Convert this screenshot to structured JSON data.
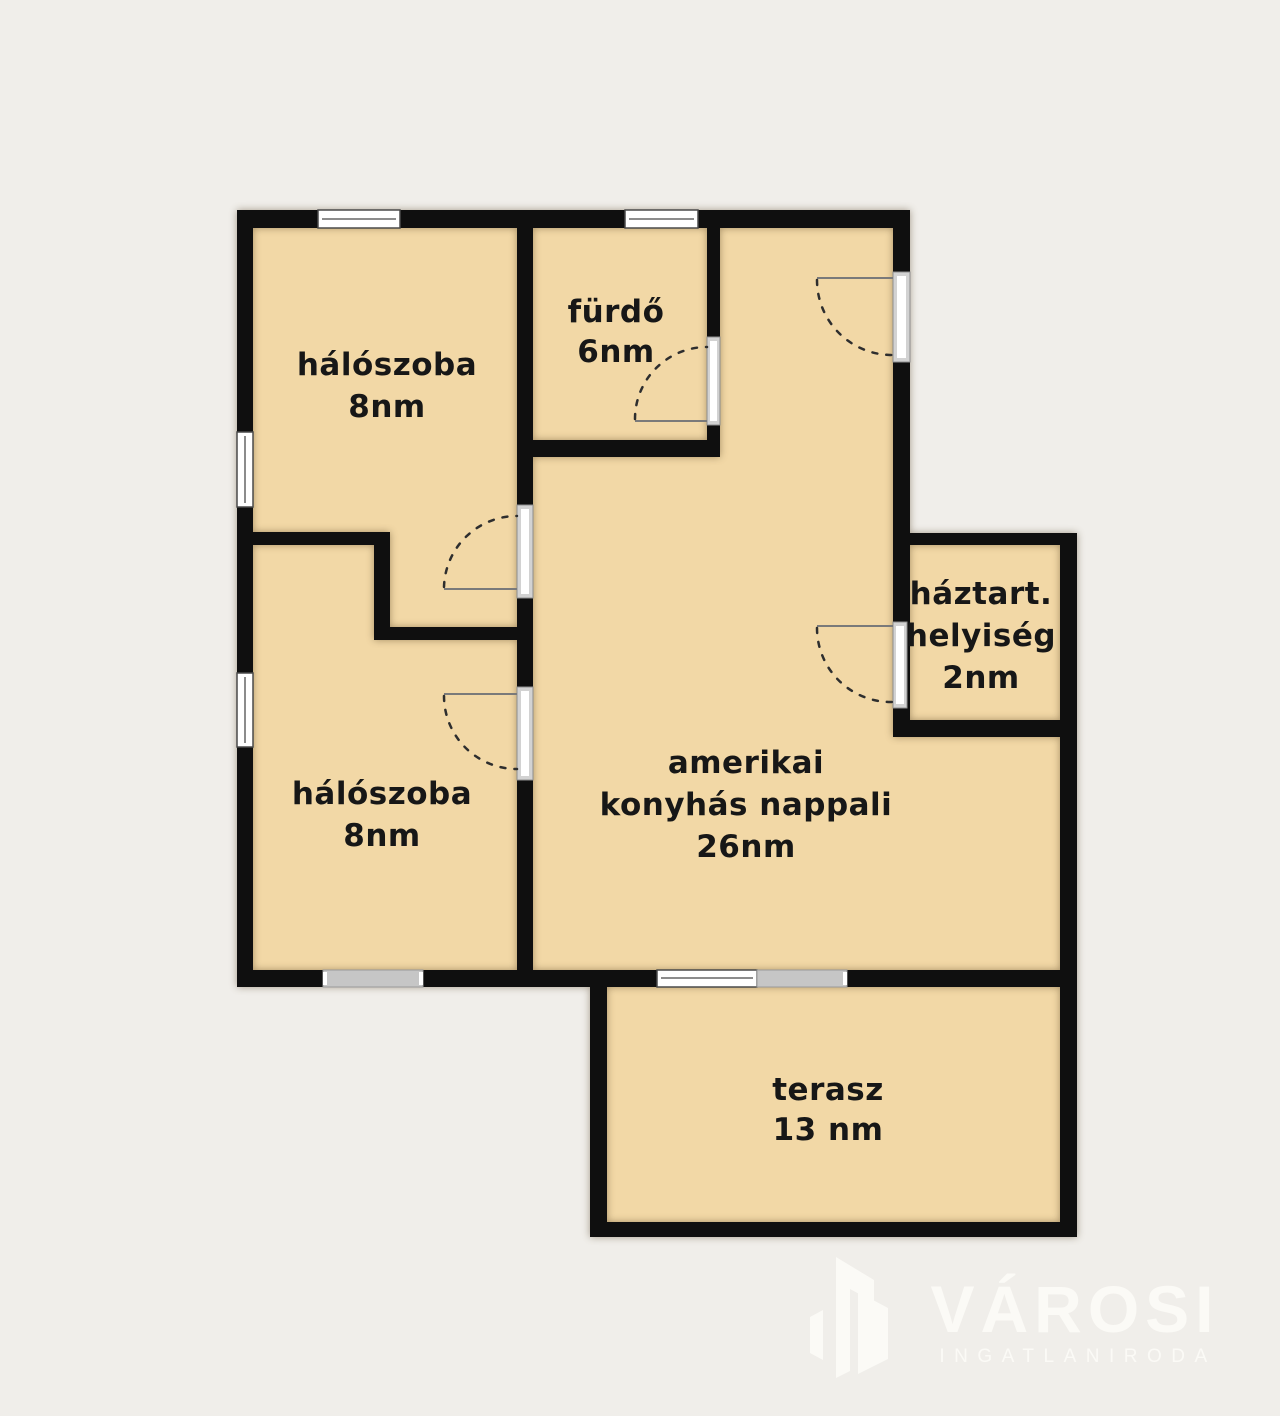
{
  "plan": {
    "rooms": [
      {
        "key": "bedroom_top",
        "lines": [
          "hálószoba"
        ],
        "area": "8nm"
      },
      {
        "key": "bathroom",
        "lines": [
          "fürdő"
        ],
        "area": "6nm"
      },
      {
        "key": "utility",
        "lines": [
          "háztart.",
          "helyiség"
        ],
        "area": "2nm"
      },
      {
        "key": "living",
        "lines": [
          "amerikai",
          "konyhás nappali"
        ],
        "area": "26nm"
      },
      {
        "key": "bedroom_bottom",
        "lines": [
          "hálószoba"
        ],
        "area": "8nm"
      },
      {
        "key": "terrace",
        "lines": [
          "terasz"
        ],
        "area": "13 nm"
      }
    ]
  },
  "logo": {
    "name": "VÁROSI",
    "tagline": "INGATLANIRODA"
  },
  "colors": {
    "bg": "#f0eeea",
    "room": "#f2d8a6",
    "wall": "#0f0f0f",
    "win_gray": "#c6c6c6",
    "label": "#171717",
    "logo": "#fbfaf6"
  }
}
